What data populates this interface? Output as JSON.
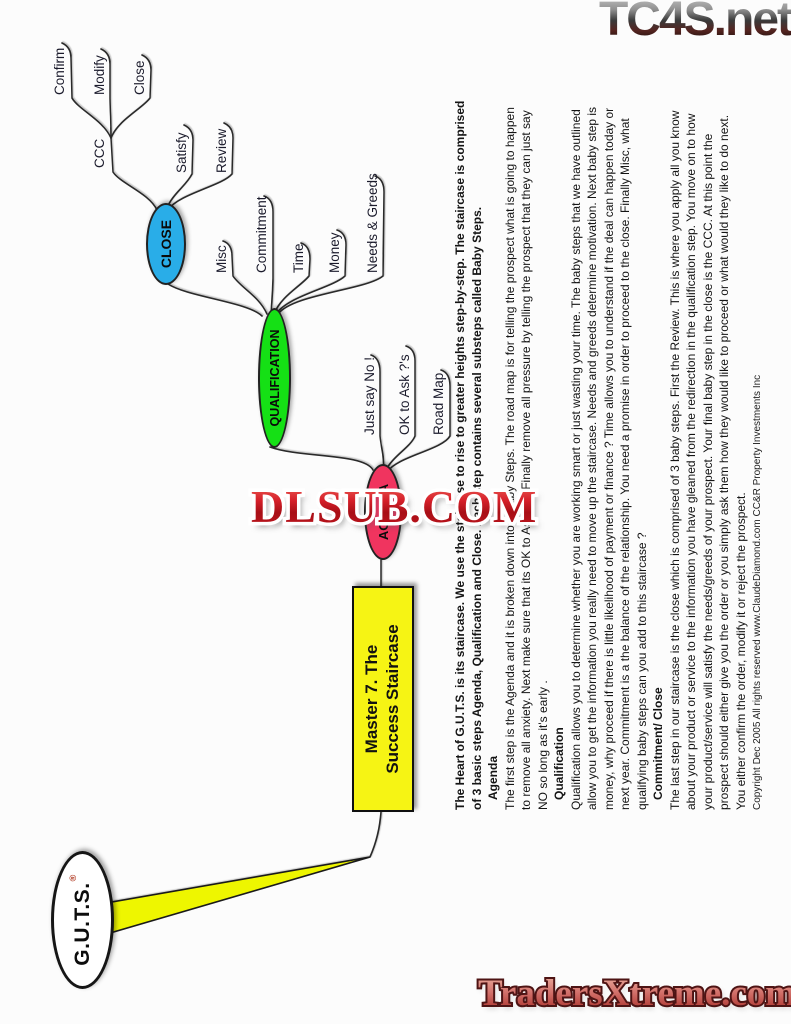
{
  "watermarks": {
    "top_right": "TC4S.net",
    "center": "DLSUB.COM",
    "bottom": "TradersXtreme.com"
  },
  "mindmap": {
    "root": {
      "label": "G.U.T.S.",
      "registered_mark": "®"
    },
    "main_topic": {
      "line1": "Master 7. The",
      "line2": "Success Staircase",
      "color": "#f6f414"
    },
    "topics": [
      {
        "label": "AGENDA",
        "color": "#f0345f"
      },
      {
        "label": "QUALIFICATION",
        "color": "#15e015"
      },
      {
        "label": "CLOSE",
        "color": "#29ade8"
      }
    ],
    "agenda_children": [
      "Just say No !",
      "OK to Ask ?'s",
      "Road Map"
    ],
    "qualification_children": [
      "Misc",
      "Commitment",
      "Time",
      "Money",
      "Needs & Greeds"
    ],
    "close_children": [
      "CCC",
      "Satisfy",
      "Review"
    ],
    "ccc_children": [
      "Confirm",
      "Modify",
      "Close"
    ]
  },
  "article": {
    "lines": [
      "The Heart of G.U.T.S. is its staircase. We use the staircase to rise to greater heights step-by-step. The staircase is comprised",
      "of 3 basic steps Agenda, Qualification and Close. Each step contains several substeps called Baby Steps.",
      "Agenda",
      "The first step is the Agenda and it is broken down into 3 baby Steps. The road map is for telling the prospect what is going to happen",
      "to remove all anxiety. Next make sure that its OK to Ask ?'s. Finally remove all pressure by telling the prospect that they can just say",
      "NO so long as it's early .",
      "Qualification",
      "Qualification allows you to determine whether you are working smart or just wasting your time. The baby steps that we have outlined",
      "allow you to get the information you really need to move up the staircase. Needs and greeds determine motivation. Next baby step is",
      "money, why proceed if there is little likelihood of payment or finance ? Time allows you to understand if the deal can happen today or",
      "next year. Commitment is a the balance of the relationship. You need a promise in order to proceed to the close. Finally Misc, what",
      "qualifying baby steps can you add to this staircase ?",
      "Commitment/ Close",
      "The last step in our staircase is the close which is comprised of 3 baby steps. First the Review. This is where you apply all you know",
      "about your product or service to the information you have gleaned from the redirection in the qualification step. You move on to how",
      "your product/service will satisfy the needs/greeds of your prospect. Your final baby step in the close is the CCC. At this point the",
      "prospect should either give you the order or you simply ask them how they would like to proceed or what would they like to do next.",
      "You either confirm the order, modify it or reject the prospect.",
      "Copyright Dec 2005 All rights reserved  www.ClaudeDiamond.com CC&R Property Investments Inc"
    ]
  }
}
